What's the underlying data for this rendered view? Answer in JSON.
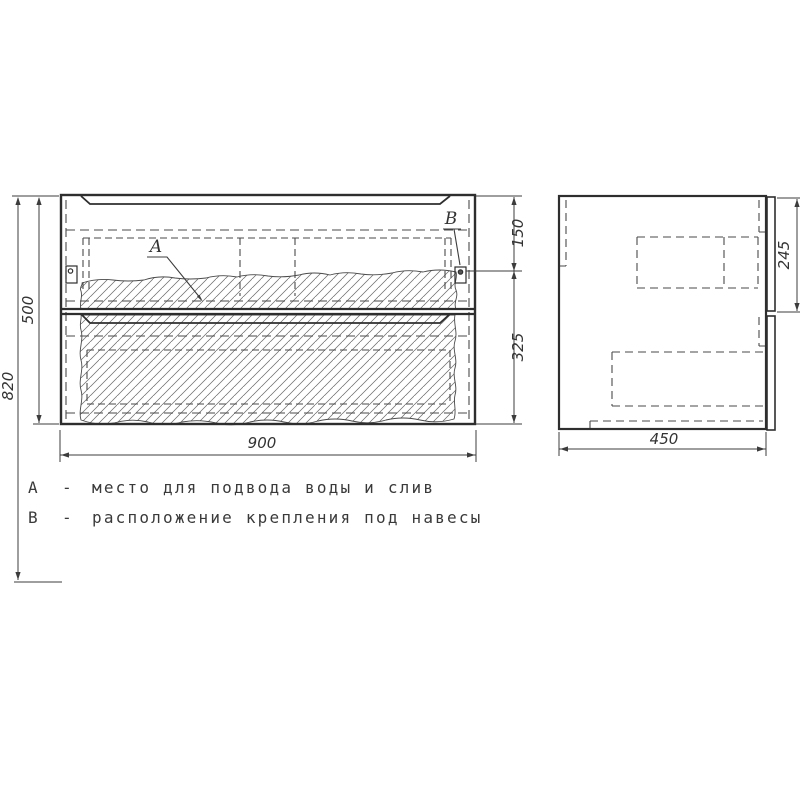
{
  "drawing": {
    "dimensions": {
      "overall_height": "820",
      "carcass_height": "500",
      "width": "900",
      "depth": "450",
      "bracket_offset_top": "150",
      "bracket_offset_bottom": "325",
      "side_top_section": "245"
    },
    "callouts": {
      "a": "A",
      "b": "B"
    },
    "legend": [
      {
        "key": "A",
        "dash": "-",
        "text": "место для подвода воды и слив"
      },
      {
        "key": "B",
        "dash": "-",
        "text": "расположение крепления под навесы"
      }
    ],
    "colors": {
      "line": "#2e2e2e",
      "thin_line": "#3c3c3c",
      "background": "#ffffff"
    }
  }
}
